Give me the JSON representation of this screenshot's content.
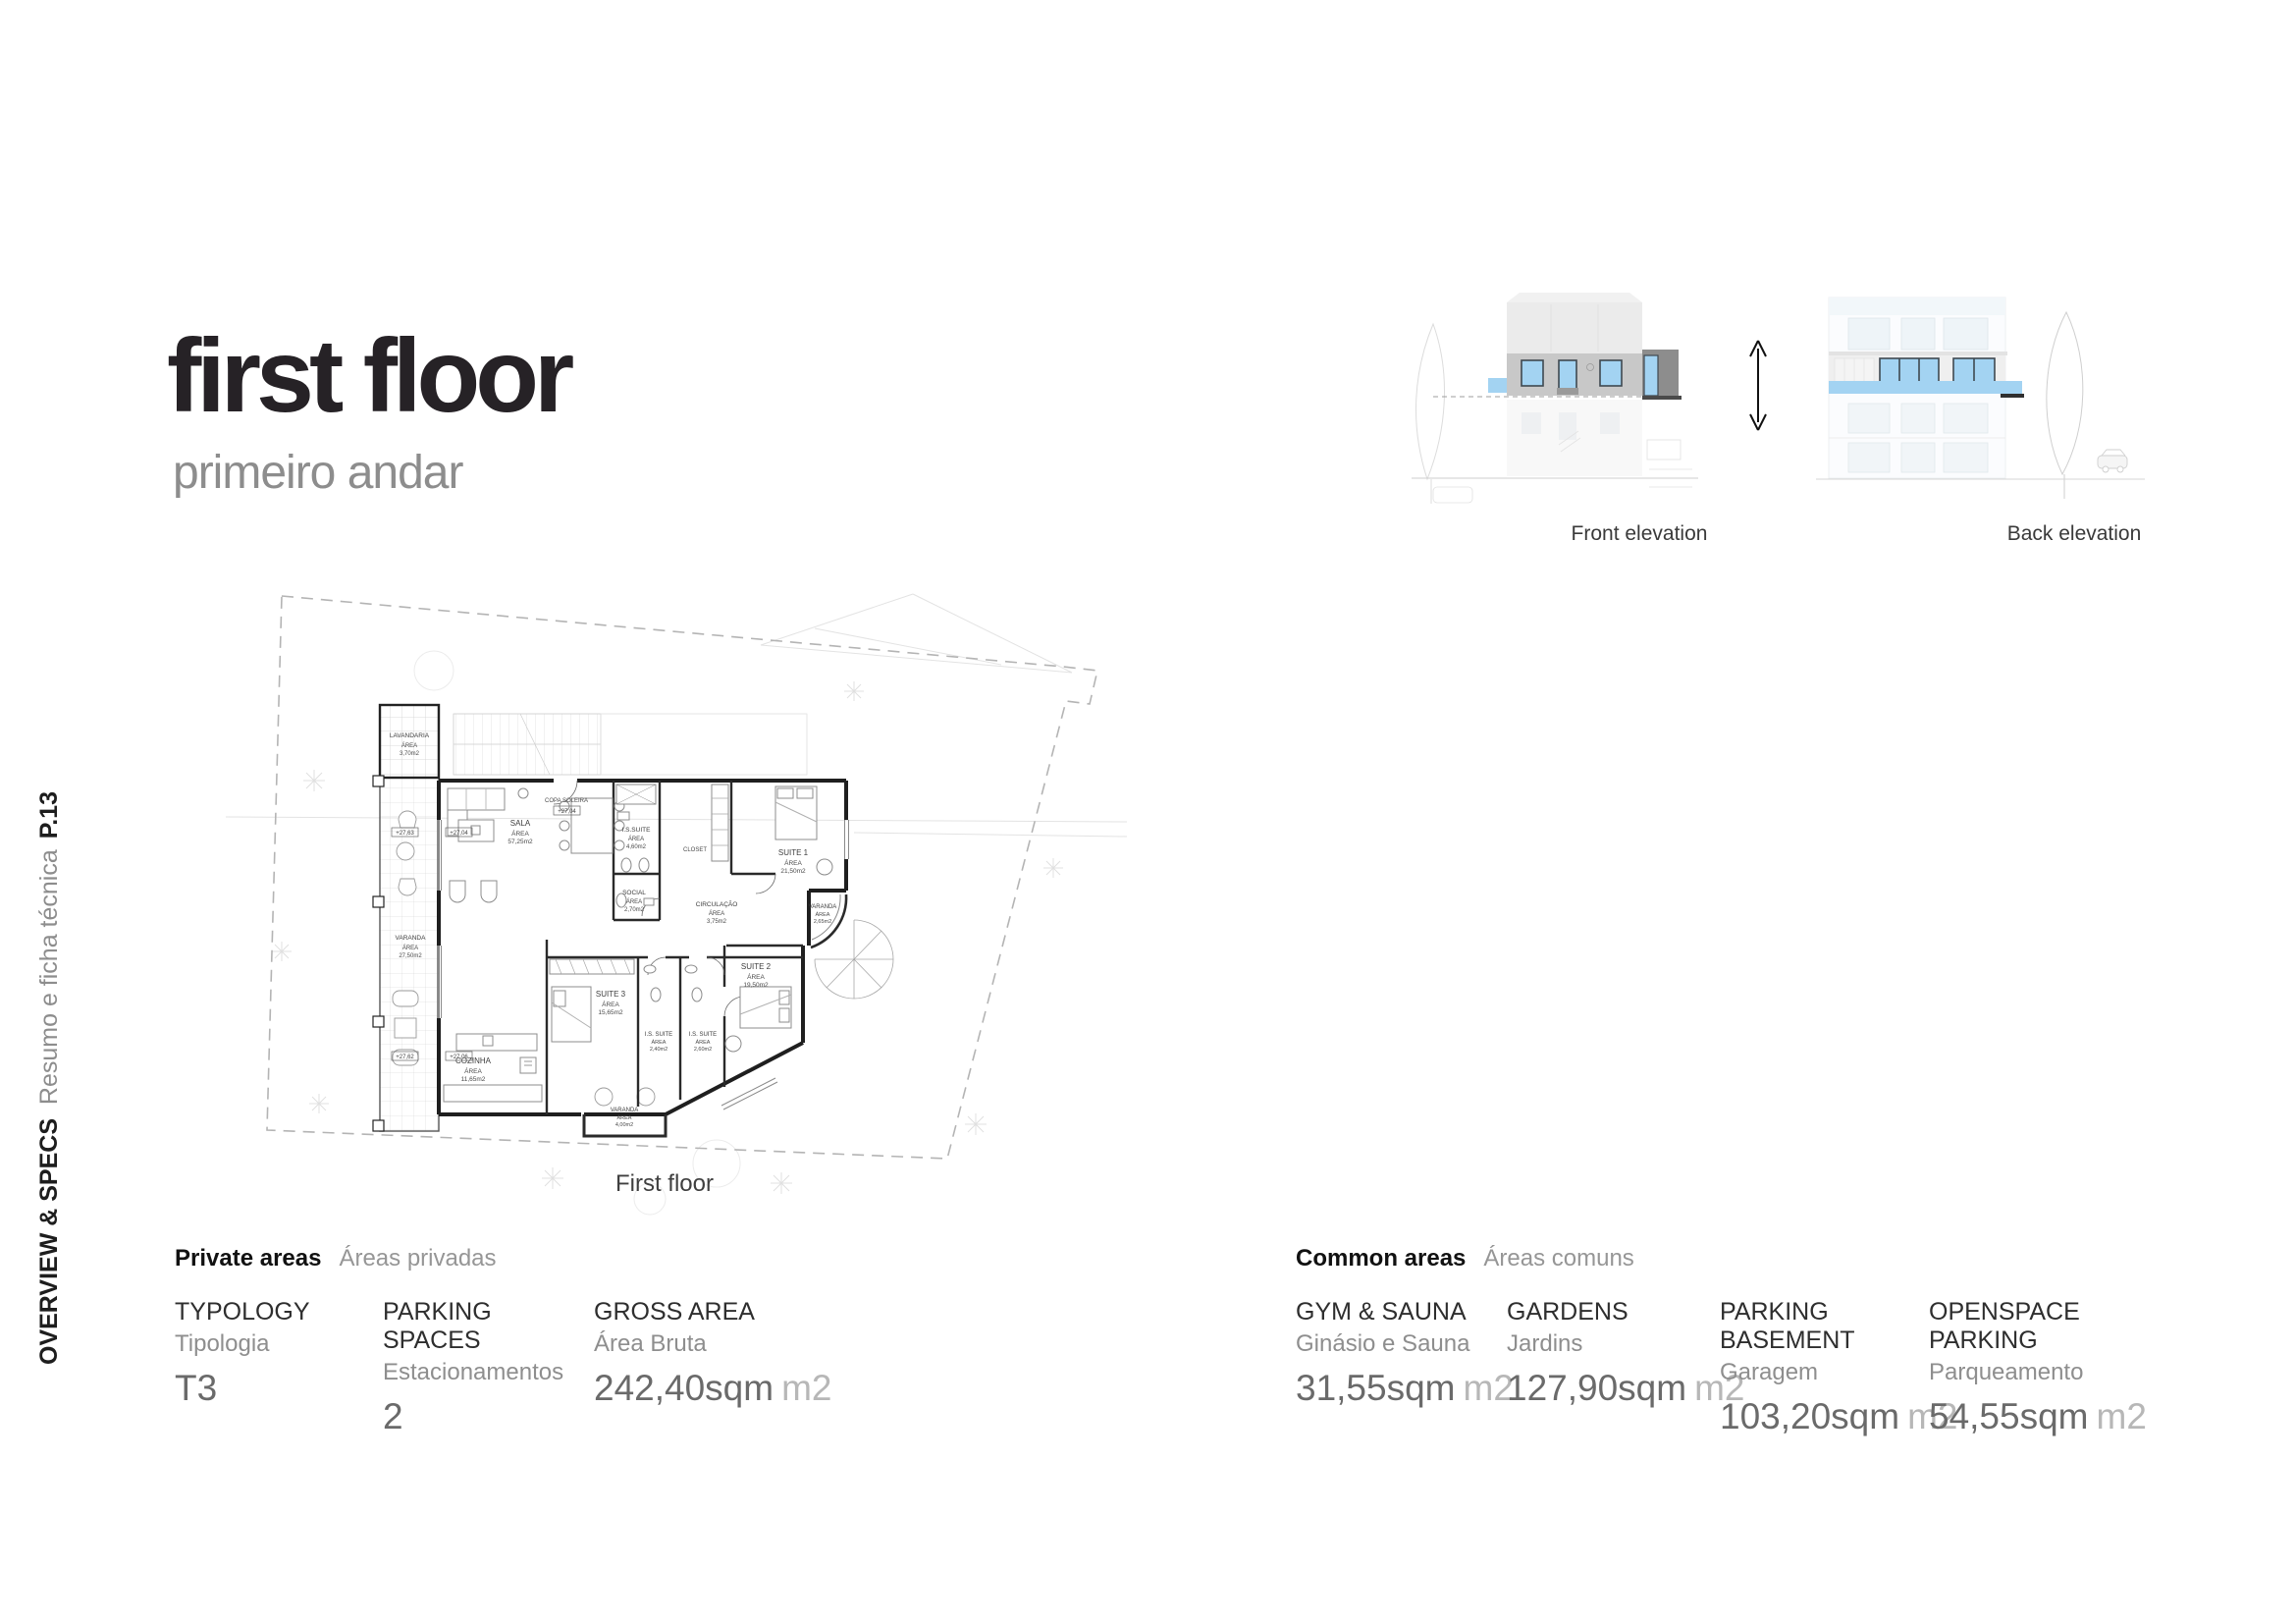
{
  "page": {
    "number": "P.13",
    "section_title": "OVERVIEW & SPECS",
    "section_subtitle": "Resumo e ficha técnica"
  },
  "header": {
    "title": "first floor",
    "subtitle": "primeiro andar"
  },
  "elevations": {
    "front_label": "Front elevation",
    "back_label": "Back elevation"
  },
  "plan": {
    "caption": "First floor",
    "area_label": "ÁREA",
    "rooms": [
      {
        "name": "LAVANDARIA",
        "area": "3,70m2"
      },
      {
        "name": "VARANDA",
        "area": "27,50m2"
      },
      {
        "name": "SALA",
        "area": "57,25m2"
      },
      {
        "name": "I.S.SUITE",
        "area": "4,60m2"
      },
      {
        "name": "CLOSET",
        "area": ""
      },
      {
        "name": "SUITE 1",
        "area": "21,50m2"
      },
      {
        "name": "SOCIAL",
        "area": "2,70m2"
      },
      {
        "name": "CIRCULAÇÃO",
        "area": "3,75m2"
      },
      {
        "name": "VARANDA",
        "area": "2,65m2"
      },
      {
        "name": "COZINHA",
        "area": "11,65m2"
      },
      {
        "name": "SUITE 3",
        "area": "15,65m2"
      },
      {
        "name": "I.S. SUITE",
        "area": "2,40m2"
      },
      {
        "name": "I.S. SUITE",
        "area": "2,60m2"
      },
      {
        "name": "SUITE 2",
        "area": "19,50m2"
      },
      {
        "name": "VARANDA",
        "area": "4,00m2"
      }
    ],
    "annotations": {
      "copa": "COPA SOLEIRA",
      "level_copa": "+27,04",
      "level_sala_out": "+27,63",
      "level_sala_in": "+27,04",
      "level_kitchen_out": "+27,62",
      "level_kitchen_in": "+27,06"
    }
  },
  "specs": {
    "private": {
      "title": "Private areas",
      "subtitle": "Áreas privadas",
      "items": [
        {
          "label": "TYPOLOGY",
          "sublabel": "Tipologia",
          "value": "T3",
          "unit": ""
        },
        {
          "label": "PARKING SPACES",
          "sublabel": "Estacionamentos",
          "value": "2",
          "unit": ""
        },
        {
          "label": "GROSS AREA",
          "sublabel": "Área Bruta",
          "value": "242,40sqm",
          "unit": "m2"
        }
      ]
    },
    "common": {
      "title": "Common areas",
      "subtitle": "Áreas comuns",
      "items": [
        {
          "label": "GYM & SAUNA",
          "sublabel": "Ginásio e Sauna",
          "value": "31,55sqm",
          "unit": "m2"
        },
        {
          "label": "GARDENS",
          "sublabel": "Jardins",
          "value": "127,90sqm",
          "unit": "m2"
        },
        {
          "label": "PARKING BASEMENT",
          "sublabel": "Garagem",
          "value": "103,20sqm",
          "unit": "m2"
        },
        {
          "label": "OPENSPACE PARKING",
          "sublabel": "Parqueamento",
          "value": "54,55sqm",
          "unit": "m2"
        }
      ]
    }
  },
  "colors": {
    "accent_blue": "#a3d3f2",
    "band_gray": "#c8c8c8",
    "dark_gray": "#8d8d8d",
    "title_black": "#262226",
    "text_gray": "#8d8d8d"
  }
}
